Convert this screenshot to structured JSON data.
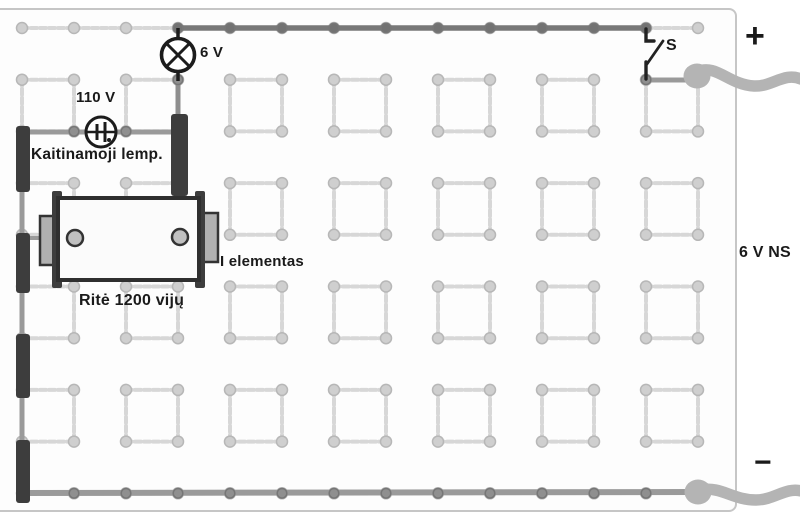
{
  "figure": {
    "type": "circuit-wiring-diagram",
    "description_visible_text_only": true
  },
  "board": {
    "grid": {
      "cols": 14,
      "rows": 10,
      "origin_x": 22,
      "origin_y": 28,
      "spacing_x": 52,
      "spacing_y": 51.7
    },
    "square_row_pairs": [
      1,
      3,
      5,
      7
    ],
    "square_col_pairs": [
      0,
      2,
      4,
      6,
      8,
      10,
      12
    ]
  },
  "labels": {
    "lamp_6v": "6 V",
    "lamp_110v_rating": "110 V",
    "lamp_110v_name": "Kaitinamoji lemp.",
    "coil_name": "Ritė 1200 vijų",
    "cell_name": "I elementas",
    "switch": "S",
    "terminal_plus": "+",
    "terminal_minus": "−",
    "source": "6 V NS"
  },
  "components": [
    {
      "type": "lamp",
      "symbol": "circle-with-cross",
      "label": "6 V"
    },
    {
      "type": "lamp",
      "symbol": "circle-with-filament-bars",
      "rating": "110 V",
      "name": "Kaitinamoji lemp."
    },
    {
      "type": "coil",
      "name": "Ritė 1200 vijų",
      "terminals": 2
    },
    {
      "type": "cell",
      "name": "I elementas"
    },
    {
      "type": "switch",
      "label": "S",
      "state": "open"
    },
    {
      "type": "power-source",
      "label": "6 V NS",
      "terminals": [
        "+",
        "−"
      ]
    }
  ],
  "colors": {
    "wire_gray": "#9a9a9a",
    "wire_dark": "#787878",
    "connector_black": "#3d3d3d",
    "pale_grid": "#d7d7d7",
    "thick_lead": "#b4b4b4",
    "symbol_ink": "#1c1c1c",
    "text": "#1a1a1a",
    "board_border": "#c6c6c6"
  }
}
